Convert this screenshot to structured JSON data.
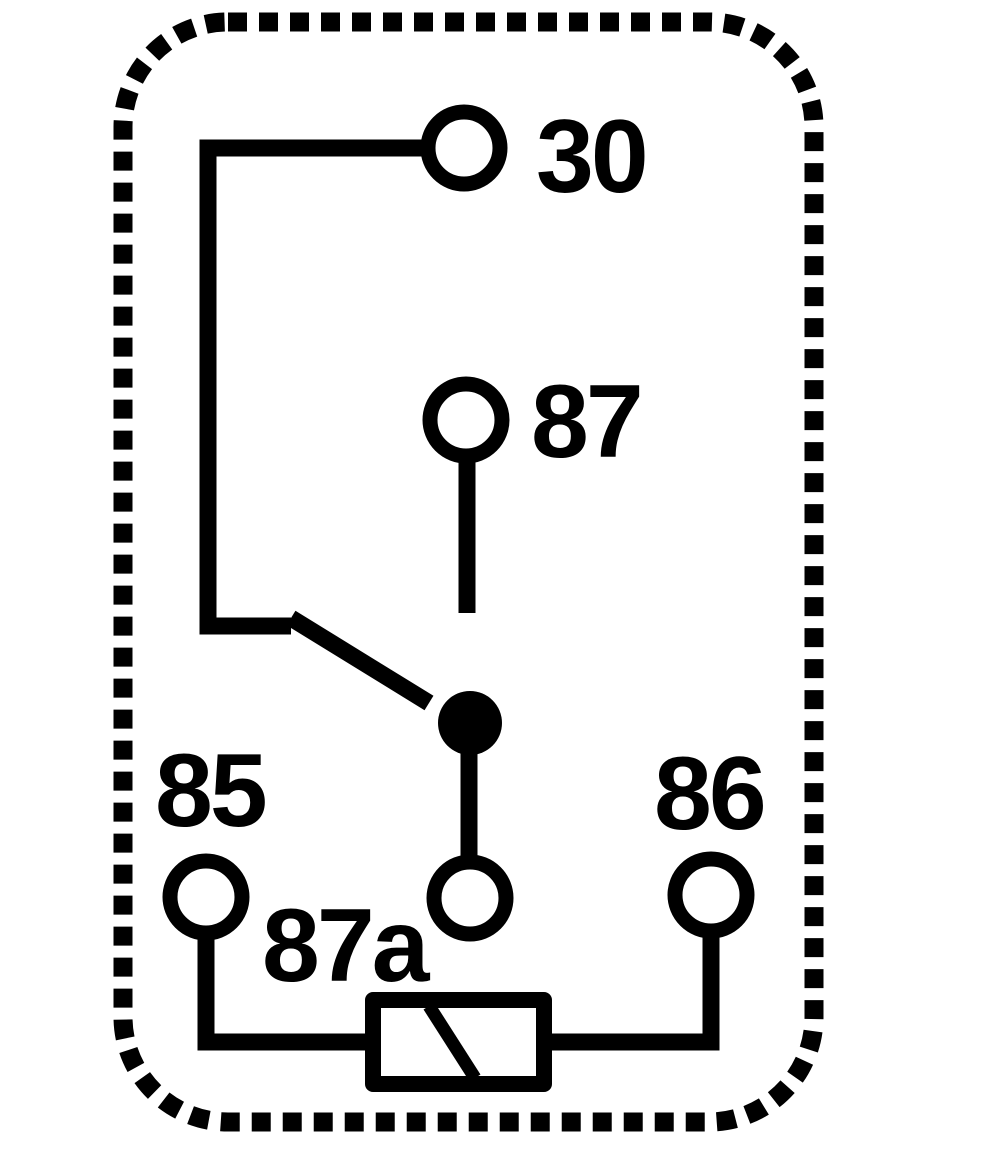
{
  "diagram": {
    "kind": "relay-pinout-schematic",
    "colors": {
      "background": "#ffffff",
      "stroke": "#000000",
      "label_text": "#000000"
    },
    "labels": {
      "terminal_30": "30",
      "terminal_87": "87",
      "terminal_87a": "87a",
      "terminal_85": "85",
      "terminal_86": "86"
    }
  }
}
